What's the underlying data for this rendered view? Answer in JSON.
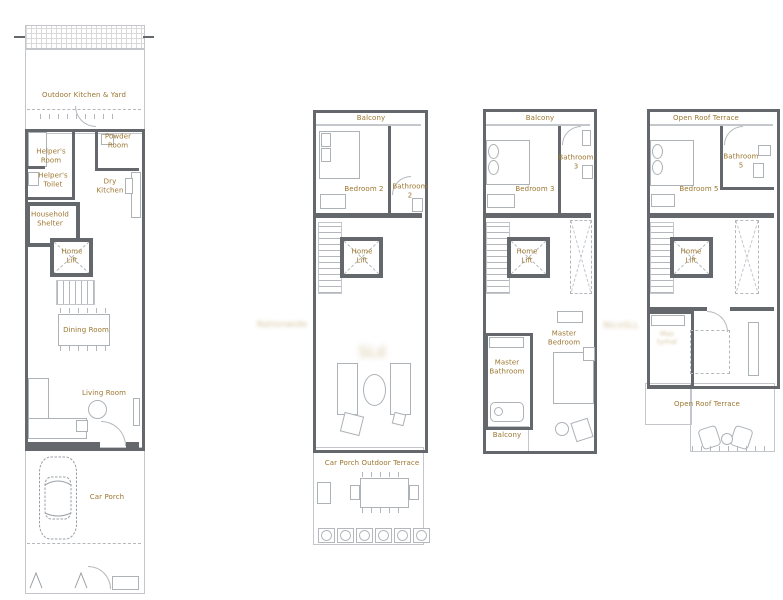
{
  "palette": {
    "label_color": "#9c762f",
    "wall_color": "#64676c",
    "line_color": "#b4b8bc",
    "background": "#ffffff",
    "watermark_color": "#c6ae7b"
  },
  "plans": {
    "first_storey": {
      "labels": {
        "outdoor_kitchen_yard": "Outdoor Kitchen & Yard",
        "powder_room": "Powder\nRoom",
        "helpers_room": "Helper's\nRoom",
        "helpers_toilet": "Helper's\nToilet",
        "dry_kitchen": "Dry\nKitchen",
        "household_shelter": "Household\nShelter",
        "home_lift": "Home\nLift",
        "dining_room": "Dining Room",
        "living_room": "Living Room",
        "car_porch": "Car Porch"
      }
    },
    "second_storey": {
      "labels": {
        "balcony": "Balcony",
        "bedroom_2": "Bedroom 2",
        "bathroom_2": "Bathroom\n2",
        "home_lift": "Home\nLift",
        "car_porch_outdoor_terrace": "Car Porch Outdoor Terrace"
      }
    },
    "third_storey": {
      "labels": {
        "balcony_front": "Balcony",
        "bedroom_3": "Bedroom 3",
        "bathroom_3": "Bathroom\n3",
        "home_lift": "Home\nLift",
        "master_bedroom": "Master\nBedroom",
        "master_bathroom": "Master\nBathroom",
        "balcony_rear": "Balcony"
      }
    },
    "attic": {
      "labels": {
        "open_roof_terrace_front": "Open Roof Terrace",
        "bedroom_5": "Bedroom 5",
        "bathroom_5": "Bathroom\n5",
        "home_lift": "Home\nLift",
        "open_roof_terrace_rear": "Open Roof Terrace"
      }
    }
  },
  "watermarks": {
    "left_smudge": "Nationwide",
    "living_smudge": "SLd",
    "mid_smudge": "NicoSLL",
    "attic_room_smudge": "Mas\ntymal"
  }
}
